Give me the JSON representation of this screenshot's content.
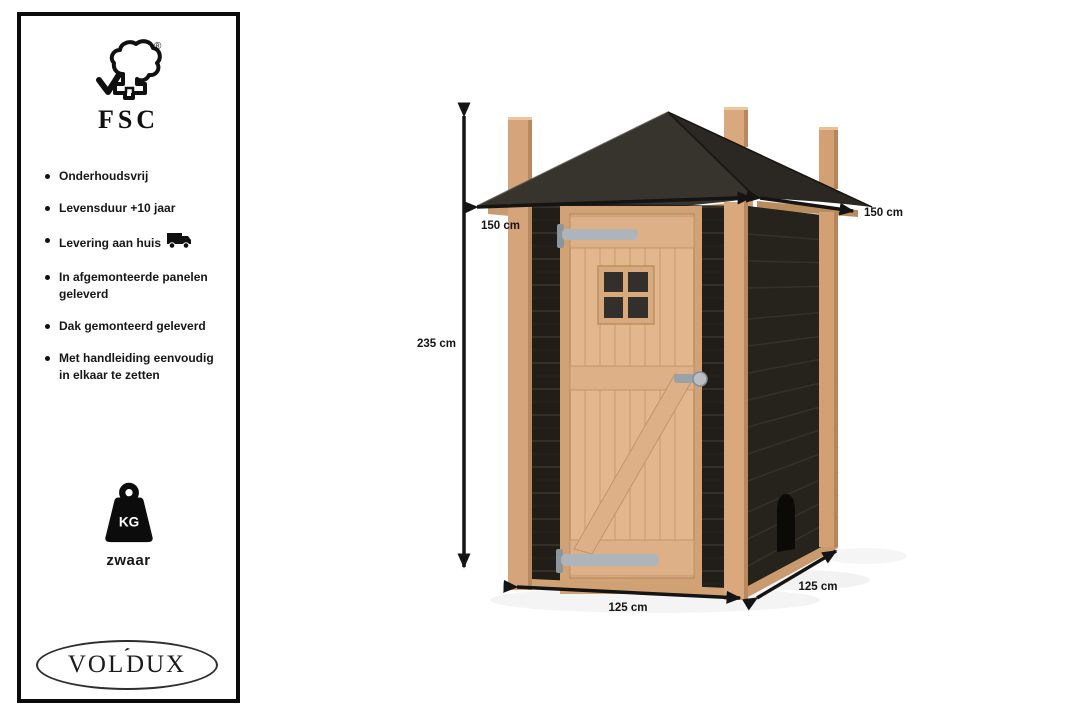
{
  "panel": {
    "fsc_label": "FSC",
    "registered_mark": "®",
    "bullets": [
      {
        "text": "Onderhoudsvrij",
        "icon": ""
      },
      {
        "text": "Levensduur +10 jaar",
        "icon": ""
      },
      {
        "text": "Levering aan huis",
        "icon": "truck-icon"
      },
      {
        "text": "In afgemonteerde panelen geleverd",
        "icon": ""
      },
      {
        "text": "Dak gemonteerd geleverd",
        "icon": ""
      },
      {
        "text": "Met handleiding eenvoudig in elkaar te zetten",
        "icon": ""
      }
    ],
    "weight_unit": "KG",
    "weight_label": "zwaar",
    "brand": {
      "left": "VOL",
      "accent": "´",
      "right": "DUX"
    }
  },
  "diagram": {
    "dimensions": {
      "height": "235 cm",
      "roof_width_front": "150 cm",
      "roof_width_side": "150 cm",
      "base_width_front": "125 cm",
      "base_depth_side": "125 cm"
    }
  },
  "icons": {
    "certification": "fsc-tree-icon",
    "delivery": "truck-icon",
    "weight": "kg-weight-icon"
  },
  "colors": {
    "wood": "#d6a47a",
    "wood_light": "#e3b78e",
    "cladding_black": "#211e19",
    "roof_dark": "#332f2a",
    "metal": "#b4bac0",
    "arrow": "#141414",
    "panel_border": "#0b0b0b",
    "background": "#ffffff"
  }
}
